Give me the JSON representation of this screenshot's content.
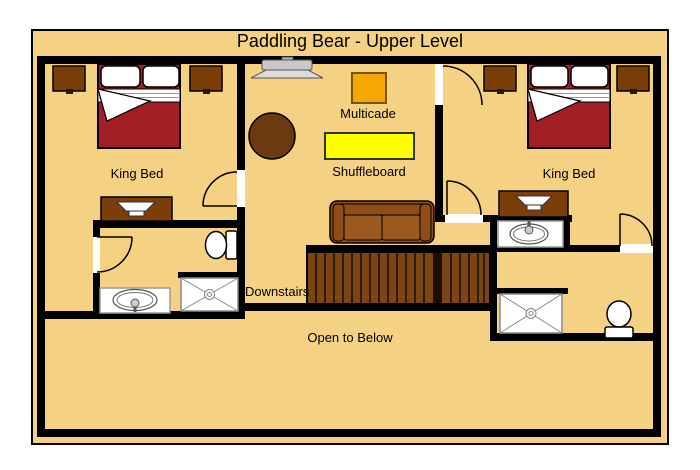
{
  "title": "Paddling Bear - Upper Level",
  "labels": {
    "left_bedroom": "King Bed",
    "right_bedroom": "King Bed",
    "multicade": "Multicade",
    "shuffleboard": "Shuffleboard",
    "stairs": "Downstairs",
    "open_area": "Open to Below"
  },
  "colors": {
    "canvas": "#F5D184",
    "wall": "#000000",
    "bed": "#A22025",
    "wood": "#7B3E08",
    "table": "#6C3A10",
    "couch": "#8F4E17",
    "couch_seat": "#9A5A1F",
    "stairs": "#7A4413",
    "stair_slat": "#2F1B05",
    "multicade": "#F5A702",
    "shuffleboard": "#FFFF00",
    "fixture": "#FFFFFF"
  }
}
